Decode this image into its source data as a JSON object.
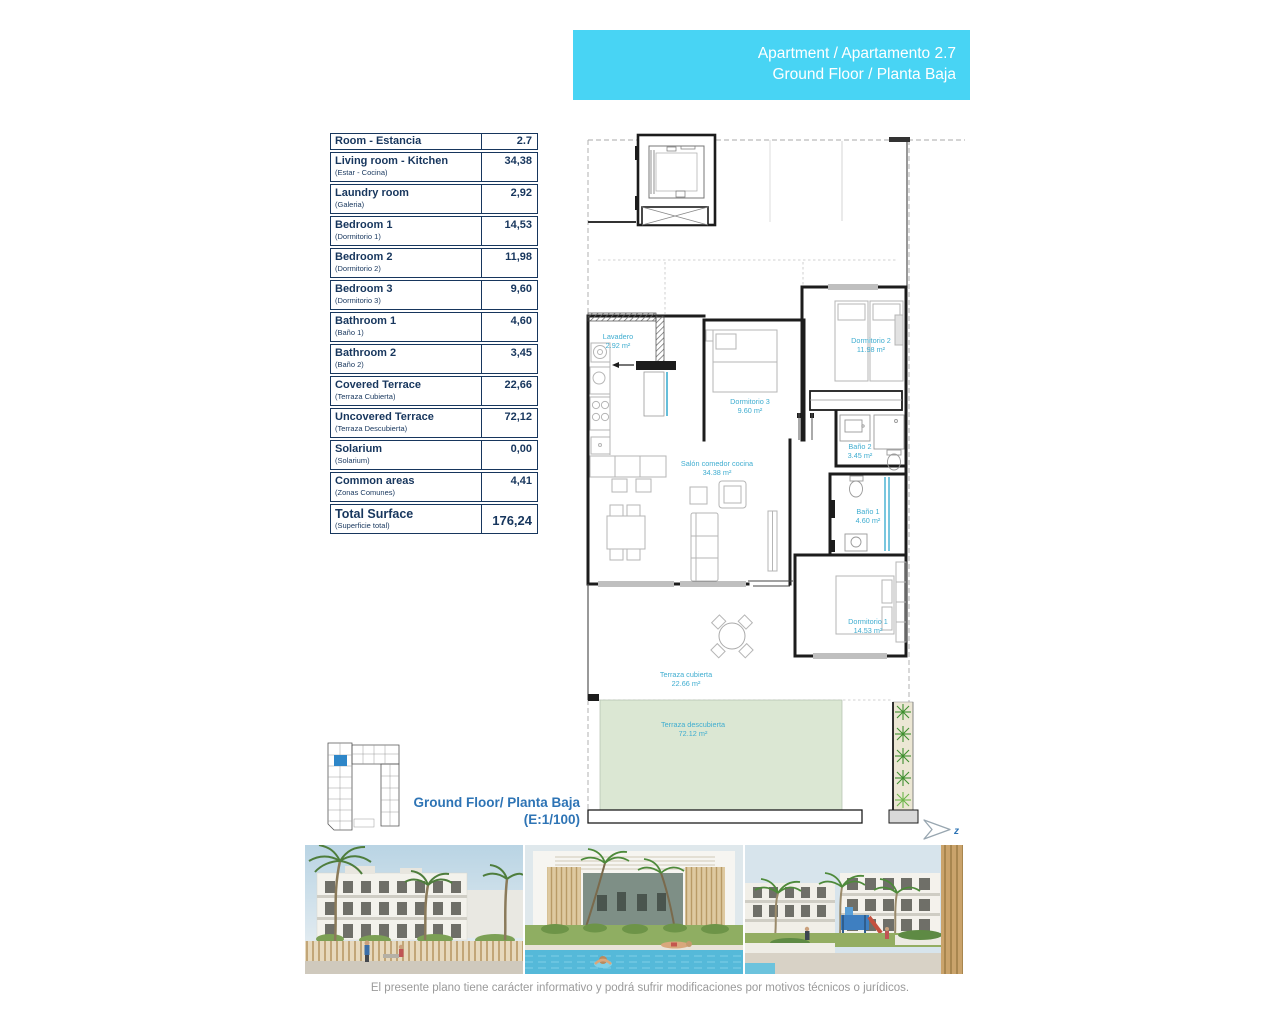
{
  "header": {
    "line1": "Apartment / Apartamento 2.7",
    "line2": "Ground Floor / Planta Baja"
  },
  "table": {
    "header": {
      "label": "Room - Estancia",
      "value": "2.7"
    },
    "rows": [
      {
        "label": "Living room - Kitchen",
        "sublabel": "(Estar - Cocina)",
        "value": "34,38"
      },
      {
        "label": "Laundry room",
        "sublabel": "(Galeria)",
        "value": "2,92"
      },
      {
        "label": "Bedroom 1",
        "sublabel": "(Dormitorio 1)",
        "value": "14,53"
      },
      {
        "label": "Bedroom 2",
        "sublabel": "(Dormitorio 2)",
        "value": "11,98"
      },
      {
        "label": "Bedroom 3",
        "sublabel": "(Dormitorio 3)",
        "value": "9,60"
      },
      {
        "label": "Bathroom 1",
        "sublabel": "(Baño 1)",
        "value": "4,60"
      },
      {
        "label": "Bathroom 2",
        "sublabel": "(Baño 2)",
        "value": "3,45"
      },
      {
        "label": "Covered Terrace",
        "sublabel": "(Terraza Cubierta)",
        "value": "22,66"
      },
      {
        "label": "Uncovered Terrace",
        "sublabel": "(Terraza Descubierta)",
        "value": "72,12"
      },
      {
        "label": "Solarium",
        "sublabel": "(Solarium)",
        "value": "0,00"
      },
      {
        "label": "Common areas",
        "sublabel": "(Zonas Comunes)",
        "value": "4,41"
      }
    ],
    "total": {
      "label": "Total Surface",
      "sublabel": "(Superficie total)",
      "value": "176,24"
    }
  },
  "plan": {
    "rooms": [
      {
        "name": "Lavadero",
        "area": "2.92 m²"
      },
      {
        "name": "Dormitorio 3",
        "area": "9.60 m²"
      },
      {
        "name": "Dormitorio 2",
        "area": "11.98 m²"
      },
      {
        "name": "Baño 2",
        "area": "3.45 m²"
      },
      {
        "name": "Salón comedor cocina",
        "area": "34.38 m²"
      },
      {
        "name": "Baño 1",
        "area": "4.60 m²"
      },
      {
        "name": "Dormitorio 1",
        "area": "14.53 m²"
      },
      {
        "name": "Terraza cubierta",
        "area": "22.66 m²"
      },
      {
        "name": "Terraza descubierta",
        "area": "72.12 m²"
      }
    ],
    "floor_label": "Ground Floor/ Planta Baja",
    "scale_label": "(E:1/100)",
    "compass_label": "z"
  },
  "footer": {
    "disclaimer": "El presente plano tiene carácter informativo y podrá sufrir modificaciones por motivos técnicos o jurídicos."
  },
  "colors": {
    "accent_cyan": "#48d4f4",
    "navy": "#17365d",
    "plan_label_cyan": "#3fadd0",
    "floor_label_blue": "#2e74b5",
    "terrace_green": "#dbe7d3"
  }
}
